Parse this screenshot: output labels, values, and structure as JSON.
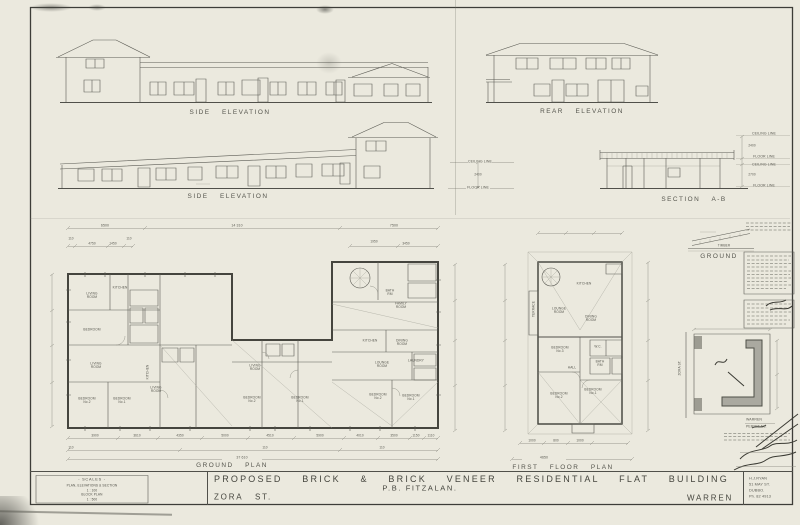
{
  "colors": {
    "paper": "#ebe9de",
    "ink": "#4e4e46",
    "pencil": "#8e8e84"
  },
  "labels": {
    "side_elevation_top": "SIDE ELEVATION",
    "rear_elevation": "REAR ELEVATION",
    "side_elevation_mid": "SIDE ELEVATION",
    "section": "SECTION A-B",
    "ground_plan": "GROUND PLAN",
    "first_floor_plan": "FIRST FLOOR PLAN",
    "detail_ground": "GROUND",
    "detail_timber": "TIMBER",
    "zora_st_vertical": "ZORA ST.",
    "terrace": "TERRACE"
  },
  "section_lines": {
    "ceiling": "CEILING LINE",
    "floor": "FLOOR LINE",
    "left_height": "2400",
    "upper_height": "2400",
    "lower_height": "2700"
  },
  "dims": {
    "ground_top": [
      "6500",
      "14 310",
      "7500"
    ],
    "ground_top_sub": [
      "110",
      "4750",
      "1450",
      "110",
      "1950",
      "3450"
    ],
    "ground_bottom": [
      "3900",
      "3610",
      "4350",
      "5000",
      "4510",
      "5900",
      "4010",
      "3500",
      "1150",
      "1110"
    ],
    "ground_bottom_sub": [
      "110",
      "110",
      "110"
    ],
    "ground_overall": "37 610",
    "first_bottom": [
      "1000",
      "800",
      "1000"
    ],
    "first_overall": "4650"
  },
  "rooms_ground": [
    "LIVING\nROOM",
    "KITCHEN",
    "BEDROOM",
    "LIVING\nROOM",
    "BEDROOM\nNo.2",
    "BEDROOM\nNo.1",
    "KITCHEN",
    "LIVING\nROOM",
    "LIVING\nROOM",
    "BEDROOM\nNo.2",
    "BEDROOM\nNo.1",
    "KITCHEN",
    "DINING\nROOM",
    "LOUNGE\nROOM",
    "FAMILY\nROOM",
    "BATH\nRM",
    "LAUNDRY",
    "BEDROOM\nNo.2",
    "BEDROOM\nNo.1"
  ],
  "rooms_first": [
    "KITCHEN",
    "LOUNGE\nROOM",
    "DINING\nROOM",
    "BEDROOM\nNo.3",
    "W.C.",
    "BATH\nRM",
    "HALL",
    "BEDROOM\nNo.2",
    "BEDROOM\nNo.1"
  ],
  "scales": {
    "heading": "- SCALES -",
    "line1": "PLAN, ELEVATIONS & SECTION",
    "value1": "1 : 100",
    "line2": "BLOCK PLAN",
    "value2": "1 : 500"
  },
  "titleblock": {
    "title": "PROPOSED BRICK & BRICK VENEER RESIDENTIAL FLAT BUILDING",
    "client": "P.B. FITZALAN.",
    "street": "ZORA ST.",
    "town": "WARREN",
    "architect": [
      "H.J.RYAN",
      "51 MAY ST.",
      "DUBBO.",
      "Ph. 82 4913"
    ]
  },
  "stamp": {
    "town": "WARREN",
    "permit": "PERMIT No."
  }
}
